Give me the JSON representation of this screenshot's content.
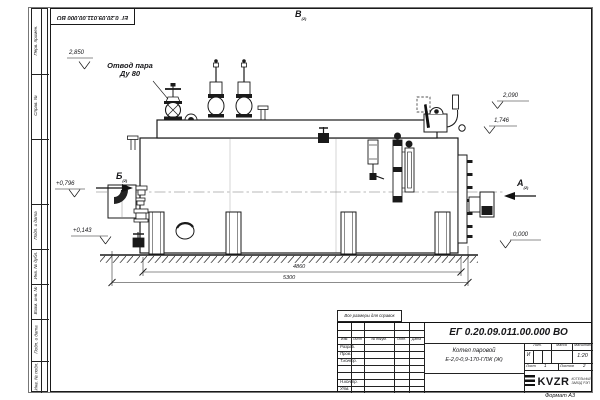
{
  "page": {
    "doc_number": "ЕГ 0.20.09.011.00.000  ВО",
    "format_label": "Формат А3",
    "note": "Все размеры для справок"
  },
  "frame_strip": {
    "cells": [
      "Перв. примен.",
      "Справ. №",
      "",
      "Подп. и дата",
      "Инв. № дубл.",
      "Взам. инв. №",
      "Подп. и дата",
      "Инв. № подл."
    ]
  },
  "views": {
    "a": "А",
    "b": "Б",
    "v": "В",
    "sheet_ref": "(2)"
  },
  "labels": {
    "steam_outlet_line1": "Отвод пара",
    "steam_outlet_line2": "Ду 80"
  },
  "elevations": {
    "top_left": "2,850",
    "right_upper": "2,090",
    "right_lower": "1,746",
    "left_upper": "+0,796",
    "left_lower": "+0,143",
    "ground_right": "0,000"
  },
  "dimensions": {
    "inner": "4860",
    "outer": "5300"
  },
  "title_block": {
    "doc_number": "ЕГ 0.20.09.011.00.000  ВО",
    "product_line1": "Котел паровой",
    "product_line2": "Е-2,0-0,9-170-ГЛЖ (Ж)",
    "header": {
      "izm": "Изм.",
      "list": "Лист",
      "doc": "№ докум.",
      "podp": "Подп.",
      "data": "Дата"
    },
    "rows": [
      "Разраб.",
      "Пров.",
      "Т.контр.",
      "Н.контр.",
      "Утв."
    ],
    "lit_label": "Лит.",
    "lit_value": "И",
    "mass_label": "Масса",
    "scale_label": "Масштаб",
    "scale_value": "1:20",
    "sheet_label": "Лист",
    "sheet_value": "1",
    "sheets_label": "Листов",
    "sheets_value": "2",
    "logo_text": "KVZR",
    "company_line1": "КОТЕЛЬНЫЙ",
    "company_line2": "ЗАВОД РЭП"
  }
}
